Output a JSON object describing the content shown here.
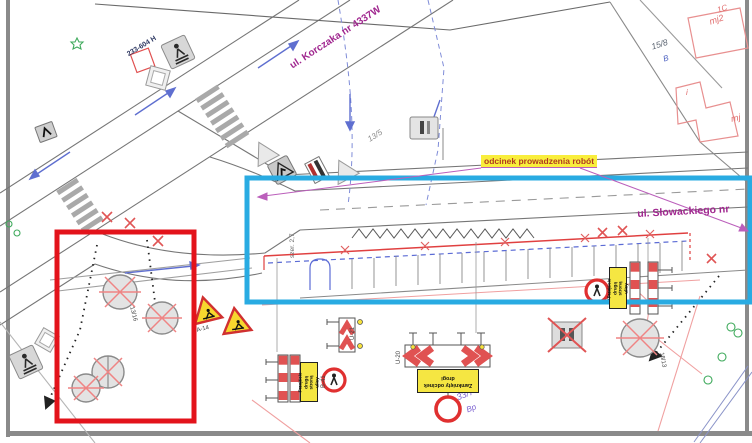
{
  "streets": {
    "korczaka": "ul. Korczaka nr 4337W",
    "slowackiego": "ul. Słowackiego nr"
  },
  "work_section": {
    "label": "odcinek prowadzenia robót"
  },
  "survey_mark": "233-604 H",
  "parcels": {
    "n13_5": "13/5",
    "n15_8": "15/8",
    "cls_b": "B",
    "n33_7": "33/7",
    "cls_bp": "Bp"
  },
  "buildings": {
    "b1": "1C",
    "b1_type": "mj2",
    "b2_type": "mj",
    "b3": "i"
  },
  "notes": {
    "width": "szer. 2,7",
    "tree_left": "13/16",
    "tree_right": "18/13"
  },
  "signs": {
    "b41": "B-41",
    "a14": "A-14",
    "u21": "U-21",
    "u20": "U-20",
    "board_side": [
      "Przejście",
      "drugą stroną",
      "ulicy"
    ],
    "board_center": [
      "Zamknięty odcinek",
      "drogi"
    ]
  },
  "colors": {
    "work_zone_box": "#29abe2",
    "removal_box": "#e3131b",
    "highlight": "#f9ee3c",
    "street_label": "#a0278f",
    "barrier_red": "#e05252",
    "board_yellow": "#f5e642",
    "leader_purple": "#bb5fbb"
  }
}
